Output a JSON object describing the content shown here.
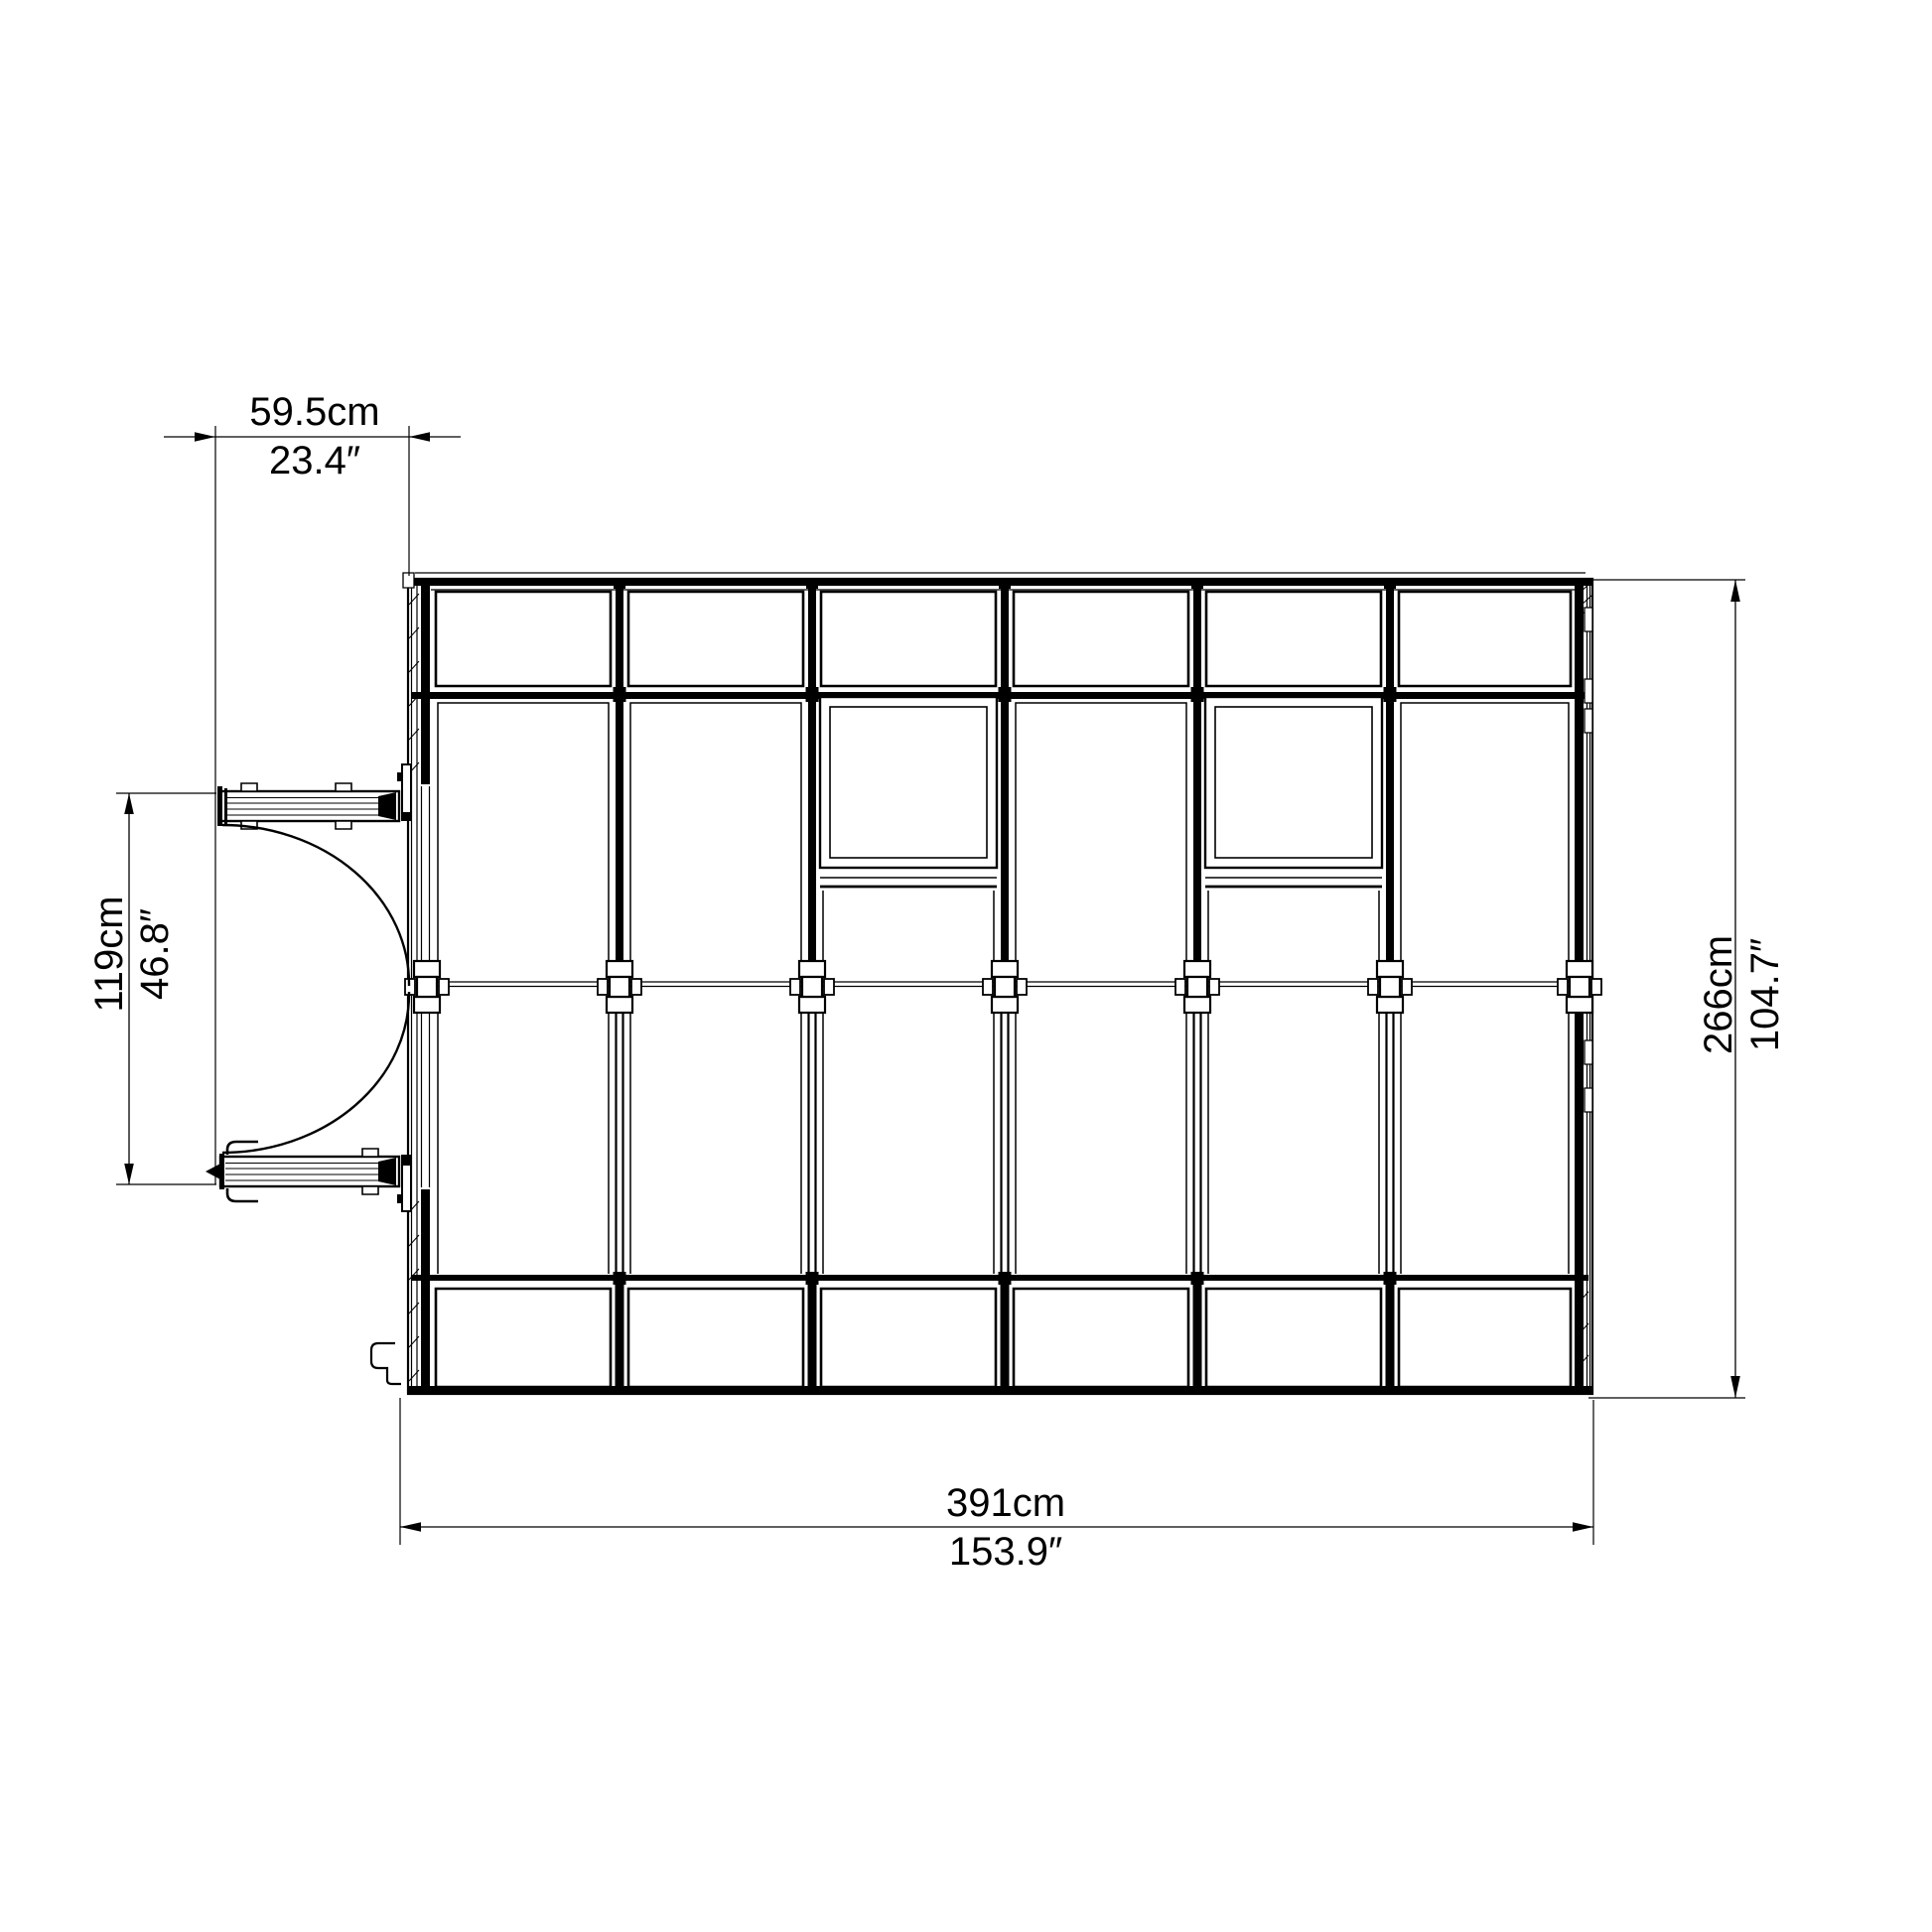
{
  "background": "#ffffff",
  "line_color": "#000000",
  "dimensions": {
    "door_width": {
      "metric": "59.5cm",
      "imperial": "23.4″"
    },
    "door_span": {
      "metric": "119cm",
      "imperial": "46.8″"
    },
    "depth": {
      "metric": "266cm",
      "imperial": "104.7″"
    },
    "width": {
      "metric": "391cm",
      "imperial": "153.9″"
    }
  },
  "structure": {
    "columns": 6,
    "roof_windows": 2,
    "door_leaves": 2,
    "ridge_connectors": 7
  }
}
